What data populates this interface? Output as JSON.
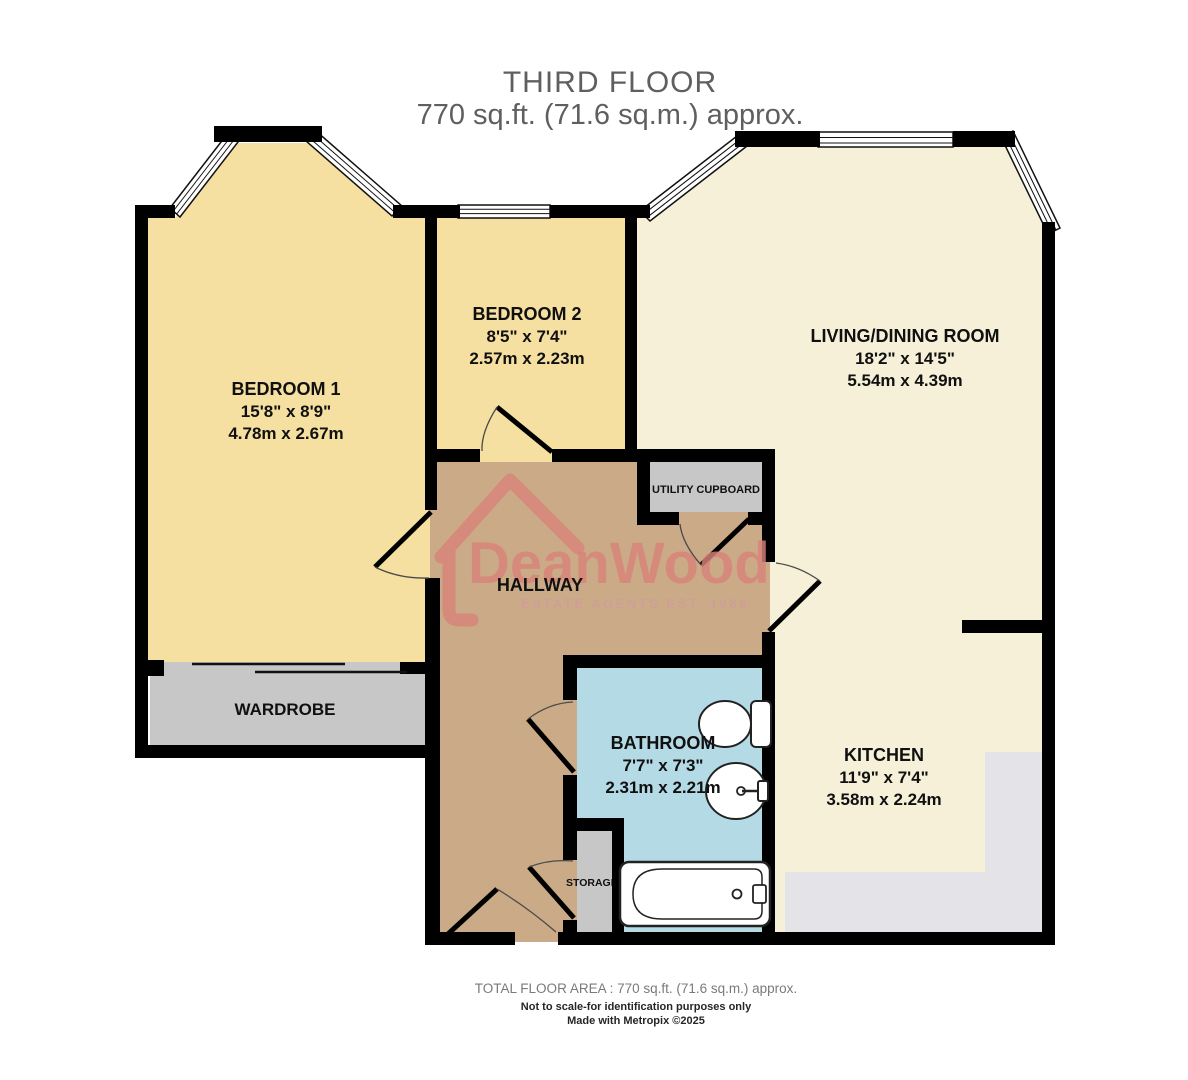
{
  "title": {
    "line1": "THIRD FLOOR",
    "line2": "770 sq.ft. (71.6 sq.m.) approx."
  },
  "rooms": {
    "bedroom1": {
      "name": "BEDROOM 1",
      "size_imperial": "15'8\"  x 8'9\"",
      "size_metric": "4.78m  x 2.67m"
    },
    "bedroom2": {
      "name": "BEDROOM 2",
      "size_imperial": "8'5\"  x 7'4\"",
      "size_metric": "2.57m  x 2.23m"
    },
    "living_dining": {
      "name": "LIVING/DINING ROOM",
      "size_imperial": "18'2\"  x 14'5\"",
      "size_metric": "5.54m  x 4.39m"
    },
    "bathroom": {
      "name": "BATHROOM",
      "size_imperial": "7'7\"  x 7'3\"",
      "size_metric": "2.31m  x 2.21m"
    },
    "kitchen": {
      "name": "KITCHEN",
      "size_imperial": "11'9\"  x 7'4\"",
      "size_metric": "3.58m  x 2.24m"
    },
    "hallway": {
      "name": "HALLWAY"
    }
  },
  "features": {
    "wardrobe": "WARDROBE",
    "utility_cupboard": "UTILITY CUPBOARD",
    "storage": "STORAGE"
  },
  "logo": {
    "brand": "DeanWood",
    "tagline": "ESTATE AGENTS EST. 1986"
  },
  "footer": {
    "total_area": "TOTAL FLOOR AREA : 770 sq.ft. (71.6 sq.m.) approx.",
    "disclaimer": "Not to scale-for identification purposes only",
    "credit": "Made with Metropix ©2025"
  },
  "colors": {
    "wall": "#000000",
    "bedroom_fill": "#f5e0a1",
    "living_fill": "#f6f0d8",
    "hallway_fill": "#cbab87",
    "bathroom_fill": "#b4dae5",
    "fixture_grey": "#c7c7c7",
    "counter_grey": "#e3e3e8",
    "logo_salmon": "#d9837a",
    "title_grey": "#5f5f5f"
  }
}
